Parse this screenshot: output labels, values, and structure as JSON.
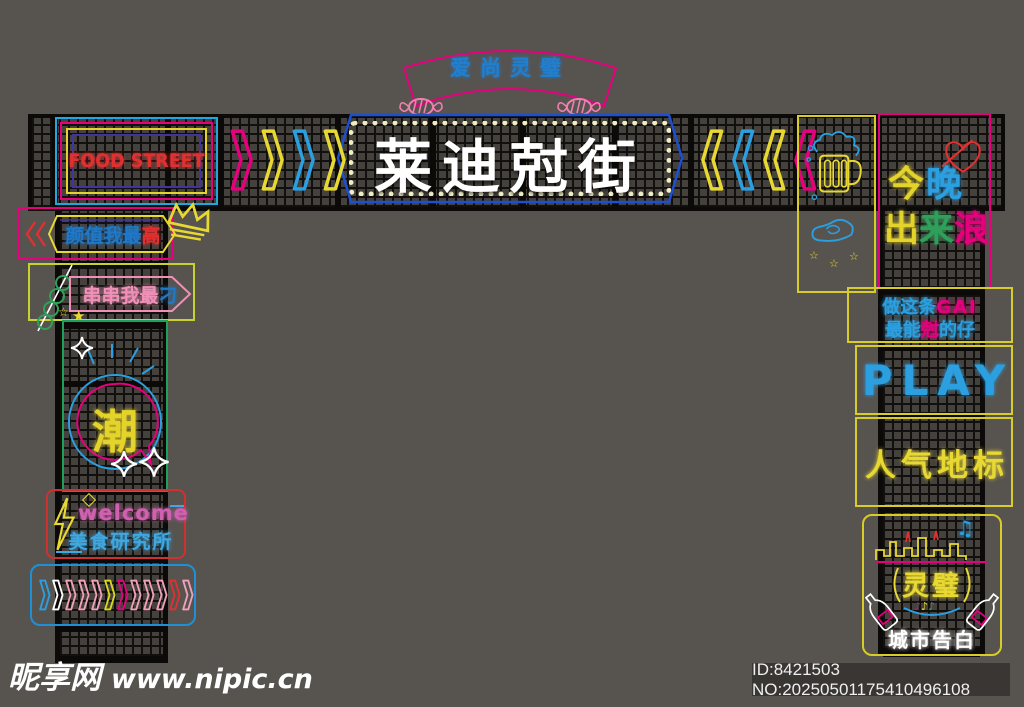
{
  "banner": {
    "title": "爱尚灵璧"
  },
  "main_sign": {
    "title": "莱迪尅街"
  },
  "food_street": {
    "label": "FOOD STREET"
  },
  "beauty_sign": {
    "text_main": "颜值我最",
    "text_accent": "高"
  },
  "skewer_sign": {
    "text_main": "串串我最",
    "text_accent": "刁"
  },
  "trend_sign": {
    "char": "潮"
  },
  "welcome_sign": {
    "line1": "welcome",
    "line2": "美食研究所"
  },
  "night_sign": {
    "char1": "今",
    "char2": "晚",
    "char3": "出",
    "char4": "来",
    "char5": "浪"
  },
  "gai_sign": {
    "line1_a": "做这条",
    "line1_b": "GAI",
    "line2_a": "最能",
    "line2_b": "尅",
    "line2_c": "的仔"
  },
  "play_sign": {
    "label": "PLAY"
  },
  "landmark_sign": {
    "label": "人气地标"
  },
  "city_sign": {
    "badge": "灵璧",
    "caption": "城市告白"
  },
  "watermark": {
    "brand": "昵享网",
    "url": "www.nipic.cn"
  },
  "stock_bar": {
    "id_text": "ID:8421503 NO:20250501175410496108"
  },
  "icons": {
    "star_outline": "☆",
    "star_filled": "★",
    "notes_double": "♫",
    "note_single": "♪"
  },
  "colors": {
    "magenta": "#e6007e",
    "blue": "#2b9fe0",
    "deep_blue": "#1d4fd0",
    "yellow": "#e8d832",
    "yellow_green": "#c8d22a",
    "green": "#2fa05a",
    "red": "#e03030",
    "light_pink": "#f0a0b8",
    "purple": "#41349b",
    "white": "#ffffff"
  },
  "arrow_rows": {
    "top_left_colors": [
      "#e6007e",
      "#e8d832",
      "#2b9fe0",
      "#e8d832"
    ],
    "top_right_colors": [
      "#e8d832",
      "#2b9fe0",
      "#e8d832",
      "#e6007e"
    ],
    "bottom_colors": [
      "#2b9fe0",
      "#ffffff",
      "#f0a0b8",
      "#f0a0b8",
      "#f0a0b8",
      "#d8d820",
      "#e6007e",
      "#f0a0b8",
      "#f0a0b8",
      "#f0a0b8",
      "#e03030",
      "#f0a0b8"
    ]
  }
}
